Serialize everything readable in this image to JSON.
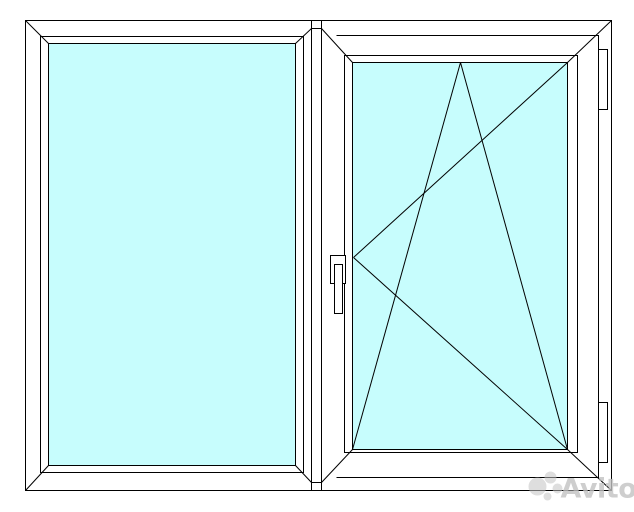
{
  "scene": {
    "background_color": "#ffffff",
    "line_color": "#000000",
    "glass_color": "#c7fdfd",
    "profile_color": "#ffffff"
  },
  "window": {
    "left_panel_type": "fixed-glazing",
    "right_panel_type": "tilt-and-turn-sash",
    "handle_side": "left-of-right-sash",
    "hinge_side": "right",
    "hinge_count": 2
  },
  "watermark": {
    "text": "Avito",
    "color": "#c2c2c2"
  }
}
